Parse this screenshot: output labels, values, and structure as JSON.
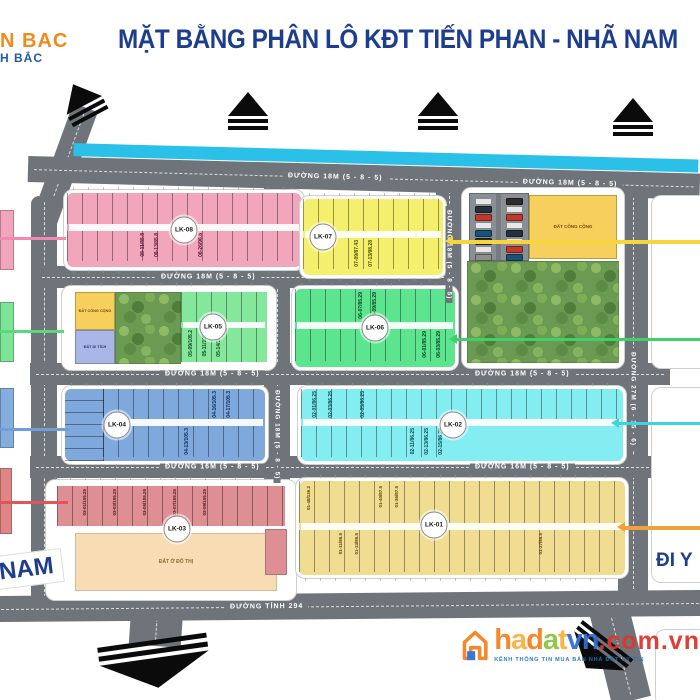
{
  "title": "MẶT BẰNG PHÂN LÔ KĐT TIẾN PHAN - NHÃ NAM",
  "logo": {
    "line1": "N BAC",
    "line2": "H BẮC"
  },
  "roads": {
    "r1a": "ĐƯỜNG 18M (5 - 8 - 5)",
    "r1b": "ĐƯỜNG 18M (5 - 8 - 5)",
    "r2": "ĐƯỜNG 18M (5 - 8 - 5)",
    "r3a": "ĐƯỜNG 18M (5 - 8 - 5)",
    "r3b": "ĐƯỜNG 18M (5 - 8 - 5)",
    "r4a": "ĐƯỜNG 16M (5 - 8 - 5)",
    "r4b": "ĐƯỜNG 16M (5 - 8 - 5)",
    "v1": "ĐƯỜNG 18M (5 - 8 - 5)",
    "v2": "ĐƯỜNG 18M (5 - 8 - 5)",
    "v3": "ĐƯỜNG 27M (6 - 15 - 6)",
    "bottom": "ĐƯỜNG TỈNH 294"
  },
  "blocks": {
    "lk08": {
      "badge": "LK-08",
      "labels": [
        "08-11/85.8",
        "08-13/85.8",
        "08-26/96.8"
      ]
    },
    "lk07": {
      "badge": "LK-07",
      "labels": [
        "07-09/87.43",
        "07-13/98.28"
      ]
    },
    "lk06": {
      "badge": "LK-06",
      "labels": [
        "06-07/85.29",
        "06-09/85.29",
        "06-01/85.29",
        "06-03/85.29"
      ]
    },
    "lk05": {
      "badge": "LK-05",
      "labels": [
        "05-09/105.2",
        "05-11/105.2",
        "05-14/105.2"
      ]
    },
    "lk04": {
      "badge": "LK-04",
      "labels": [
        "04-16/105.3",
        "04-17/105.3",
        "04-13/105.3"
      ]
    },
    "lk02": {
      "badge": "LK-02",
      "labels": [
        "02-01/86.25",
        "02-03/86.25",
        "02-05/86.25",
        "02-11/86.25",
        "02-13/86.25",
        "02-15/86.25"
      ]
    },
    "lk03": {
      "badge": "LK-03",
      "labels": [
        "03-01/105.25",
        "03-03/105.25",
        "03-05/105.25",
        "03-07/105.25",
        "03-09/105.25"
      ]
    },
    "lk01": {
      "badge": "LK-01",
      "labels": [
        "01-48/136.2",
        "01-40/87.5",
        "01-36/87.5",
        "01-11/85.5",
        "01-13/85.5",
        "01-27/85.5"
      ]
    }
  },
  "special_plots": {
    "public1": "ĐẤT CÔNG CỘNG",
    "public2": "ĐẤT CÔNG CỘNG",
    "monument": "ĐẤT DI TÍCH",
    "urban": "ĐẤT Ở ĐÔ THỊ"
  },
  "directions": {
    "south": "NAM",
    "east": "ĐI Y"
  },
  "watermark": {
    "letters": [
      "h",
      "a",
      "d",
      "a",
      "t"
    ],
    "vn": "vn",
    "domain": ".com.vn",
    "tagline": "KÊNH THÔNG TIN MUA BÁN NHÀ ĐẤT UY TÍN"
  },
  "parking": {
    "cars": [
      "#e8e8e8",
      "#24313d",
      "#c0392b",
      "#e8e8e8",
      "#1a5276",
      "#2d2d2d",
      "#e8e8e8",
      "#8e8e8e",
      "#2d2d2d",
      "#e8e8e8",
      "#c0392b",
      "#e8e8e8",
      "#24313d",
      "#e8e8e8",
      "#c0392b",
      "#1a5276"
    ]
  },
  "colors": {
    "title_blue": "#1d3d8f",
    "road_gray": "#6f747a",
    "water_cyan": "#2bc0e8",
    "lk08_pink": "#f2a6bc",
    "lk07_yellow": "#f4ef6d",
    "lk06_green": "#5ce48e",
    "lk05_green": "#84e79c",
    "lk04_blue": "#7fa9dc",
    "lk02_cyan": "#84edf2",
    "lk03_salmon": "#dd8f93",
    "lk03_beige": "#f7dcb4",
    "lk01_tan": "#f1dd92",
    "public_yellow": "#f6cf5c",
    "monument_blue": "#a9b6e6",
    "arrow_yellow": "#f7d53f",
    "arrow_green": "#3fd06a",
    "arrow_cyan": "#39d6de",
    "arrow_orange": "#f0a13a",
    "callout_pink": "#f08ab0",
    "callout_blue": "#6f9fd8",
    "callout_red": "#e05555"
  }
}
